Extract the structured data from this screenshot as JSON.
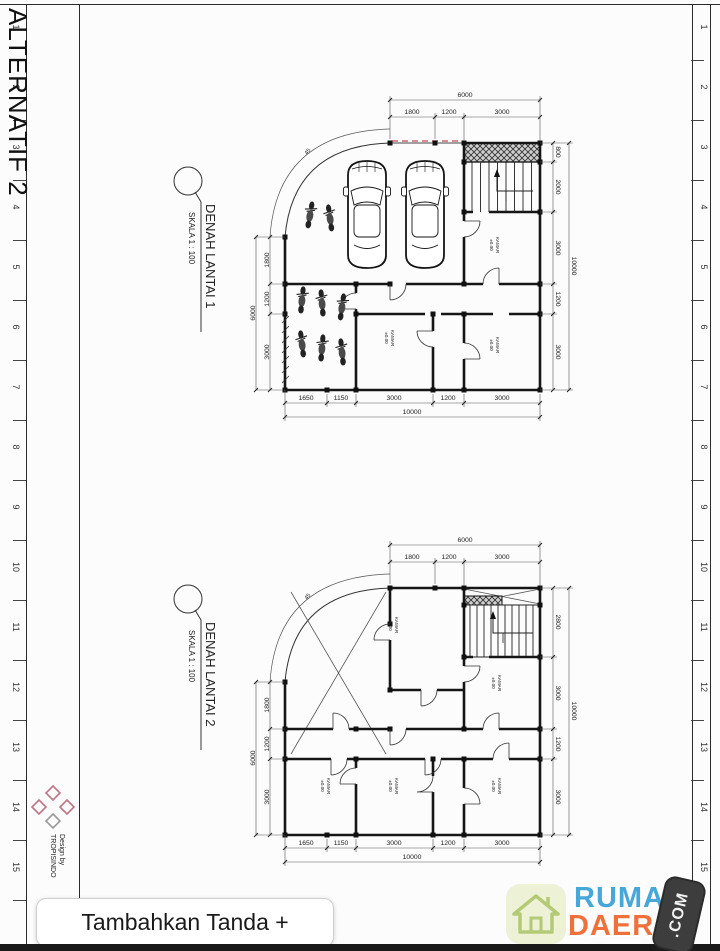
{
  "sheet": {
    "title": "ALTERNATIF 2",
    "rulers": {
      "numbers": [
        "1",
        "2",
        "3",
        "4",
        "5",
        "6",
        "7",
        "8",
        "9",
        "10",
        "11",
        "12",
        "13",
        "14",
        "15"
      ]
    },
    "titleblock": {
      "design_by": "Design by",
      "studio": "TROPISINDO"
    }
  },
  "plans": [
    {
      "name": "DENAH LANTAI 1",
      "scale": "SKALA 1 : 100",
      "arc_label": "45",
      "dims": {
        "top_total": "6000",
        "top": [
          "1800",
          "1200",
          "3000"
        ],
        "right": [
          "800",
          "2000",
          "3000",
          "1200",
          "3000"
        ],
        "right_total": "10000",
        "bottom": [
          "1650",
          "1150",
          "3000",
          "1200",
          "3000"
        ],
        "bottom_total": "10000",
        "left": [
          "1800",
          "1200",
          "3000"
        ],
        "left_total": "6000"
      },
      "rooms": [
        {
          "label": "KAMAR",
          "level": "±0.00"
        },
        {
          "label": "KAMAR",
          "level": "±0.00"
        },
        {
          "label": "KAMAR",
          "level": "±0.00"
        }
      ]
    },
    {
      "name": "DENAH LANTAI 2",
      "scale": "SKALA 1 : 100",
      "arc_label": "45",
      "dims": {
        "top_total": "6000",
        "top": [
          "1800",
          "1200",
          "3000"
        ],
        "right": [
          "2800",
          "3000",
          "1200",
          "3000"
        ],
        "right_total": "10000",
        "bottom": [
          "1650",
          "1150",
          "3000",
          "1200",
          "3000"
        ],
        "bottom_total": "10000",
        "left": [
          "1800",
          "1200",
          "3000"
        ],
        "left_total": "6000"
      },
      "rooms": [
        {
          "label": "KAMAR",
          "level": "±0.00"
        },
        {
          "label": "KAMAR",
          "level": "±0.00"
        },
        {
          "label": "KAMAR",
          "level": "±0.00"
        },
        {
          "label": "KAMAR",
          "level": "±0.00"
        },
        {
          "label": "KAMAR",
          "level": "±0.00"
        }
      ]
    }
  ],
  "overlay": {
    "add_sign_button": "Tambahkan Tanda +"
  },
  "watermark": {
    "word1": "RUMAH",
    "word2": "DAERAH",
    "suffix": ".COM"
  },
  "colors": {
    "rumah_blue": "#47a7d8",
    "daerah_orange": "#f0703c",
    "logo_green": "#b4ca77",
    "garage_line_red": "#cf6470"
  }
}
